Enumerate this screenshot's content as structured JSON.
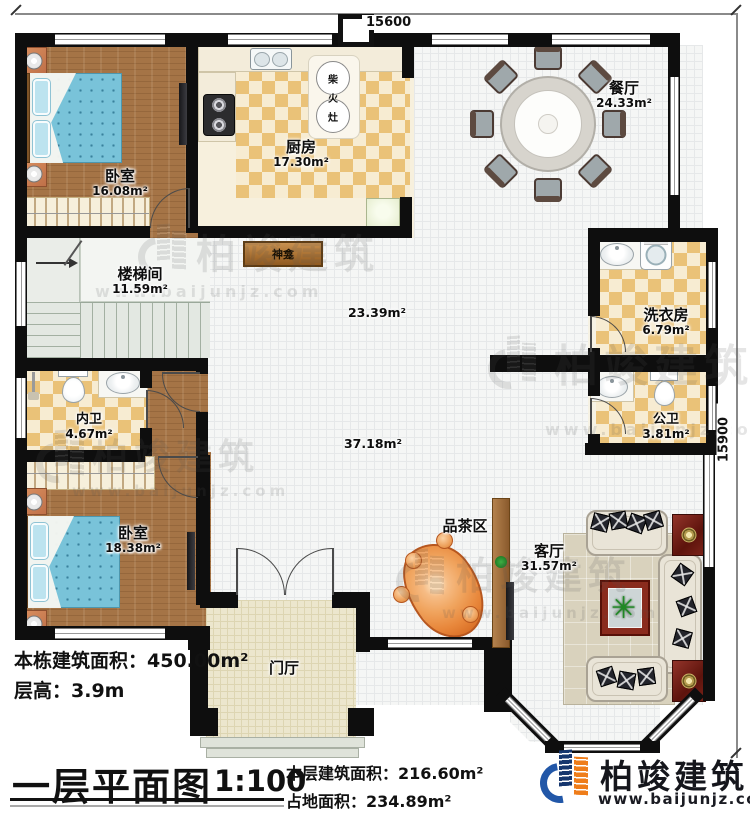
{
  "dimensions": {
    "top": "15600",
    "right": "15900"
  },
  "rooms": {
    "bedroom1": {
      "name": "卧室",
      "area": "16.08m²"
    },
    "kitchen": {
      "name": "厨房",
      "area": "17.30m²"
    },
    "dining": {
      "name": "餐厅",
      "area": "24.33m²"
    },
    "stair": {
      "name": "楼梯间",
      "area": "11.59m²"
    },
    "laundry": {
      "name": "洗衣房",
      "area": "6.79m²"
    },
    "bath_private": {
      "name": "内卫",
      "area": "4.67m²"
    },
    "bath_public": {
      "name": "公卫",
      "area": "3.81m²"
    },
    "bedroom2": {
      "name": "卧室",
      "area": "18.38m²"
    },
    "living": {
      "name": "客厅",
      "area": "31.57m²"
    },
    "tea": {
      "name": "品茶区"
    },
    "foyer": {
      "name": "门厅"
    },
    "hall": {
      "upper_area": "23.39m²",
      "lower_area": "37.18m²"
    }
  },
  "features": {
    "shrine": "神龛",
    "stove_chars": [
      "柴",
      "火",
      "灶"
    ]
  },
  "title_block": {
    "building_area_label": "本栋建筑面积：",
    "building_area_value": "450.00m²",
    "floor_height_label": "层高：",
    "floor_height_value": "3.9m",
    "plan_title": "一层平面图",
    "scale": "1:100",
    "floor_area_label": "本层建筑面积：",
    "floor_area_value": "216.60m²",
    "footprint_label": "占地面积：",
    "footprint_value": "234.89m²"
  },
  "branding": {
    "company": "柏竣建筑",
    "website": "www.baijunjz.com"
  }
}
